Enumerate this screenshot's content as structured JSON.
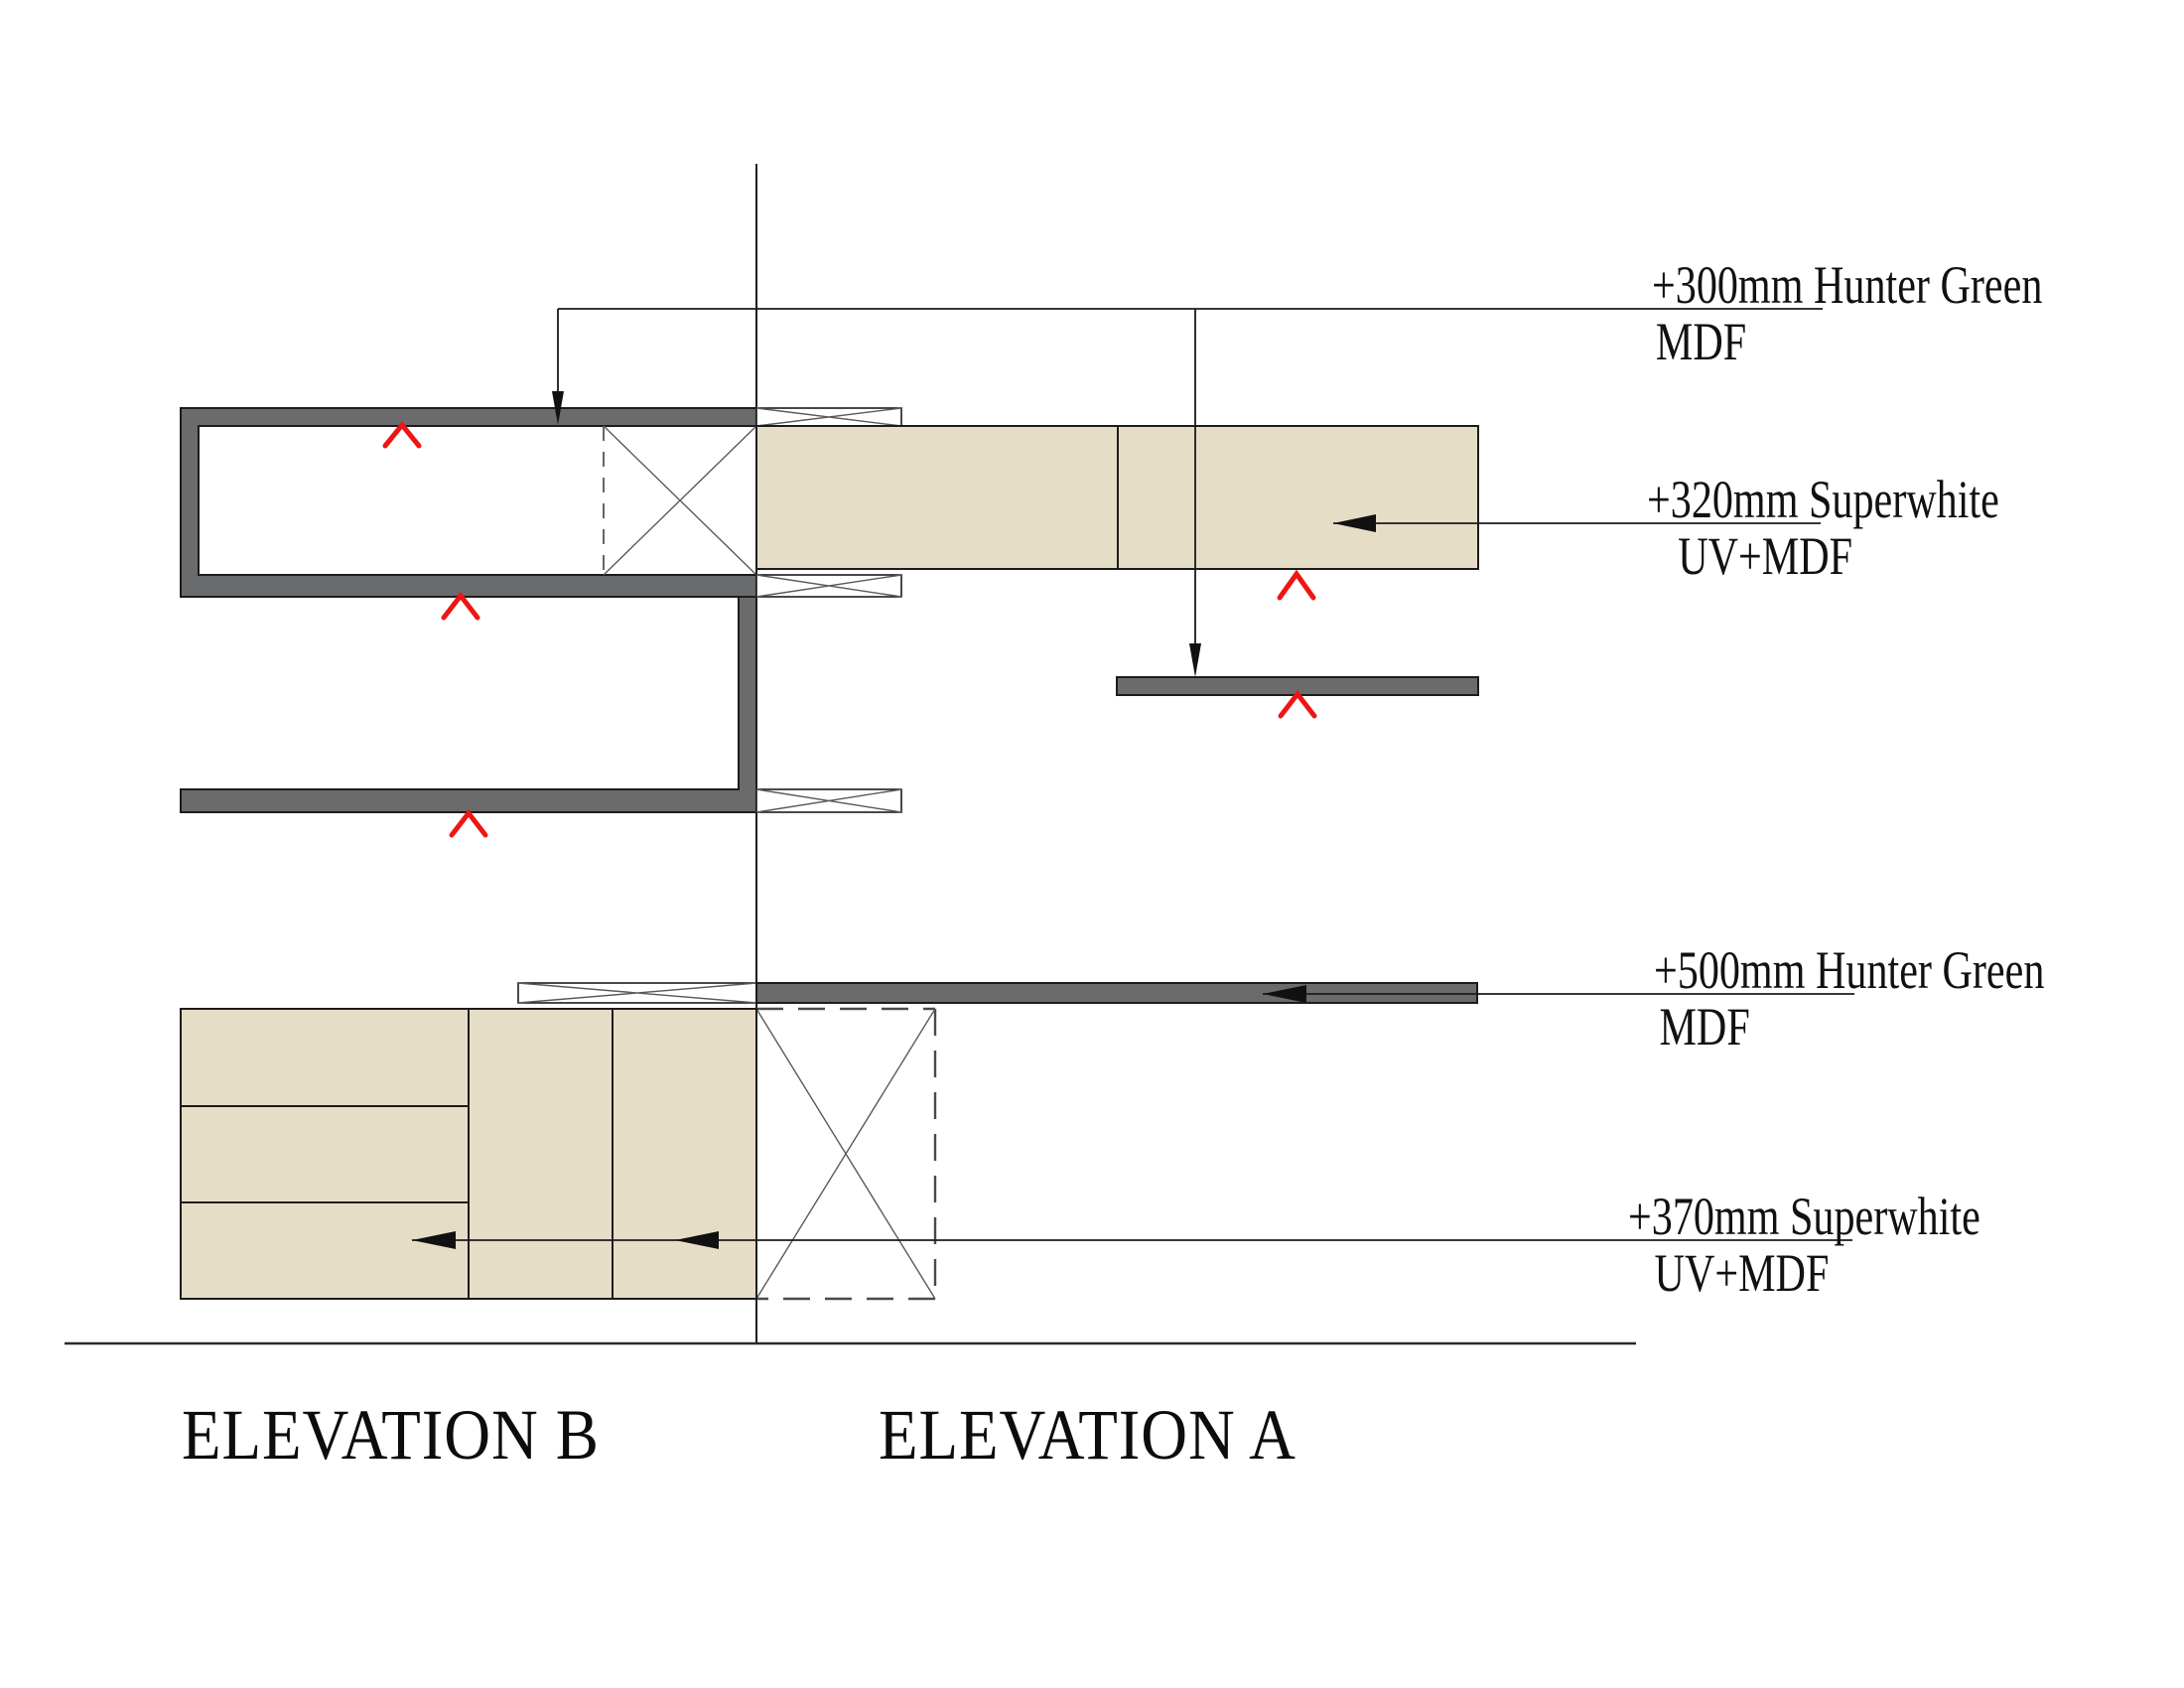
{
  "drawing": {
    "annotations": {
      "a300": {
        "line1": "+300mm Hunter Green",
        "line2": "MDF"
      },
      "a320": {
        "line1": "+320mm Superwhite",
        "line2": "UV+MDF"
      },
      "a500": {
        "line1": "+500mm Hunter Green",
        "line2": "MDF"
      },
      "a370": {
        "line1": "+370mm Superwhite",
        "line2": "UV+MDF"
      }
    },
    "titles": {
      "left": "ELEVATION B",
      "right": "ELEVATION A"
    },
    "colors": {
      "panel_gray": "#6a6b6d",
      "wood_beige": "#e6ddc6",
      "marker_red": "#ee1515",
      "line_dark": "#1c1c1c"
    }
  }
}
